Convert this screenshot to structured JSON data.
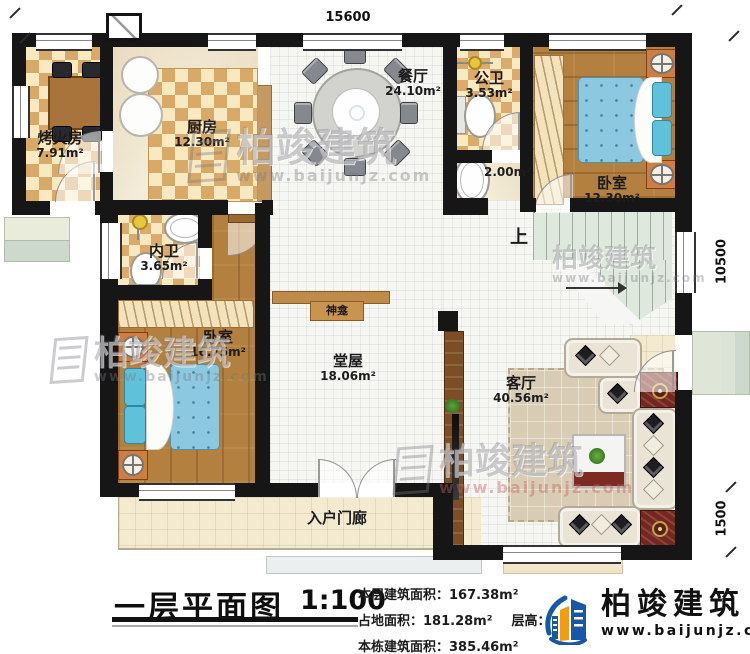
{
  "plan": {
    "title": "一层平面图",
    "scale": "1:100",
    "dims": {
      "top": "15600",
      "right_upper": "10500",
      "right_lower": "1500"
    },
    "rooms": {
      "fire_room": {
        "name": "烤火房",
        "area": "7.91m²"
      },
      "kitchen": {
        "name": "厨房",
        "area": "12.30m²"
      },
      "dining": {
        "name": "餐厅",
        "area": "24.10m²"
      },
      "public_bath": {
        "name": "公卫",
        "area": "3.53m²"
      },
      "wash_alcove": {
        "area": "2.00m²"
      },
      "bedroom_ne": {
        "name": "卧室",
        "area": "12.30m²"
      },
      "inner_bath": {
        "name": "内卫",
        "area": "3.65m²"
      },
      "bedroom_sw": {
        "name": "卧室",
        "area": "16.75m²"
      },
      "main_hall": {
        "name": "堂屋",
        "area": "18.06m²"
      },
      "living_room": {
        "name": "客厅",
        "area": "40.56m²"
      },
      "porch": {
        "name": "入户门廊"
      },
      "altar": {
        "name": "神龛"
      },
      "stairs": {
        "up_label": "上"
      }
    },
    "info": {
      "floor_area_label": "本层建筑面积：",
      "floor_area": "167.38m²",
      "land_area_label": "占地面积：",
      "land_area": "181.28m²",
      "height_label": "层高：",
      "height": "3.6",
      "total_area_label": "本栋建筑面积：",
      "total_area": "385.46m²"
    },
    "brand": {
      "name": "柏竣建筑",
      "url": "www.baijunjz.com"
    },
    "colors": {
      "brand_blue": "#1657A8",
      "brand_orange": "#F39C12",
      "wall": "#161616"
    }
  }
}
